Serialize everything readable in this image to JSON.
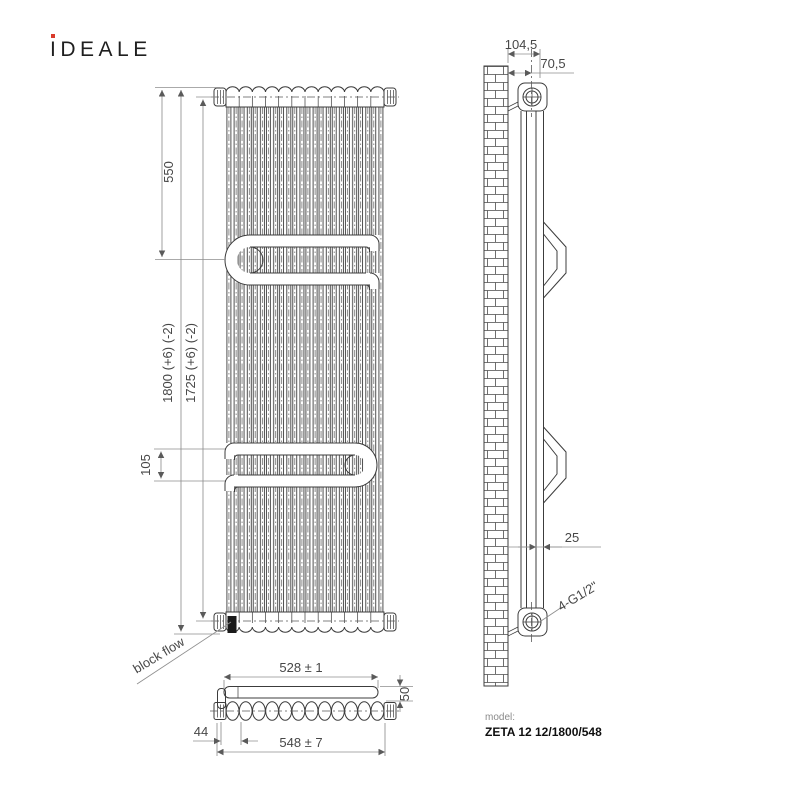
{
  "logo": {
    "brand_i": "I",
    "brand_rest": "DEALE",
    "dot_color": "#d93a2b"
  },
  "front_view": {
    "dim_550": "550",
    "dim_1800": "1800 (+6) (-2)",
    "dim_1725": "1725 (+6) (-2)",
    "dim_105": "105",
    "block_flow_label": "block flow"
  },
  "top_view": {
    "dim_528": "528 ± 1",
    "dim_50": "50",
    "dim_44": "44",
    "dim_548": "548 ± 7"
  },
  "side_view": {
    "dim_104_5": "104,5",
    "dim_70_5": "70,5",
    "dim_25": "25",
    "thread_label": "4-G1/2\""
  },
  "model": {
    "label": "model:",
    "value": "ZETA 12 12/1800/548"
  },
  "colors": {
    "line": "#3c3c3c",
    "dim": "#8f8f8f",
    "accent_red": "#d93a2b",
    "text": "#474747"
  }
}
